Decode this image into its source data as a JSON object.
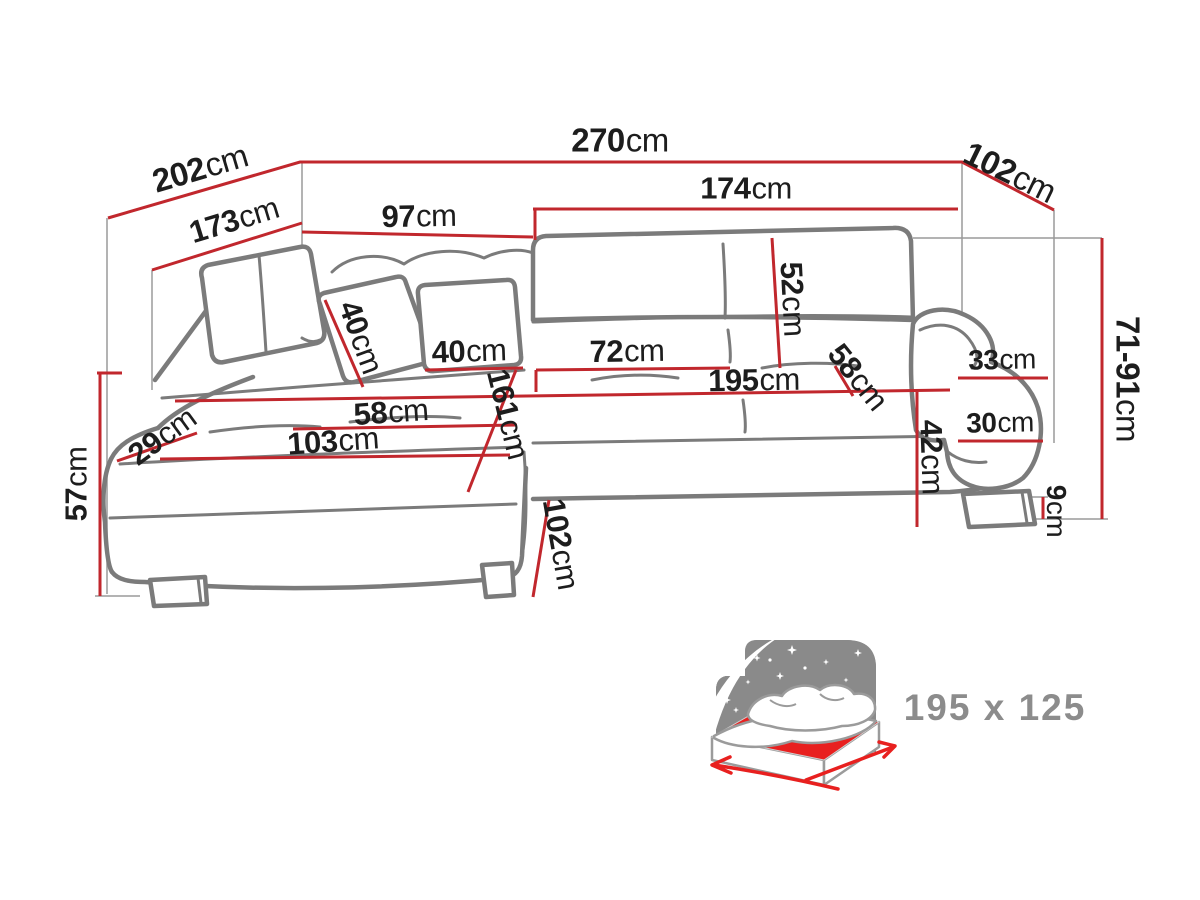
{
  "page": {
    "description": "Technical dimension diagram of a corner sofa bed with sleeping-surface icon"
  },
  "colors": {
    "red": "#c1272d",
    "outline": "#7b7b7b",
    "guide": "#9a9a9a",
    "text": "#1d1d1d",
    "icon_gray": "#8a8a8a",
    "mattress": "#e8201f",
    "bed_label": "#8c8c8c"
  },
  "dims": {
    "d202": {
      "num": "202",
      "unit": "cm"
    },
    "d270": {
      "num": "270",
      "unit": "cm"
    },
    "d102_top": {
      "num": "102",
      "unit": "cm"
    },
    "d173": {
      "num": "173",
      "unit": "cm"
    },
    "d97": {
      "num": "97",
      "unit": "cm"
    },
    "d174": {
      "num": "174",
      "unit": "cm"
    },
    "d52": {
      "num": "52",
      "unit": "cm"
    },
    "d40_left": {
      "num": "40",
      "unit": "cm"
    },
    "d40_right": {
      "num": "40",
      "unit": "cm"
    },
    "d72": {
      "num": "72",
      "unit": "cm"
    },
    "d195": {
      "num": "195",
      "unit": "cm"
    },
    "d58_right": {
      "num": "58",
      "unit": "cm"
    },
    "d58_left": {
      "num": "58",
      "unit": "cm"
    },
    "d103": {
      "num": "103",
      "unit": "cm"
    },
    "d29": {
      "num": "29",
      "unit": "cm"
    },
    "d161": {
      "num": "161",
      "unit": "cm"
    },
    "d42": {
      "num": "42",
      "unit": "cm"
    },
    "d33": {
      "num": "33",
      "unit": "cm"
    },
    "d30": {
      "num": "30",
      "unit": "cm"
    },
    "d71_91": {
      "num": "71-91",
      "unit": "cm"
    },
    "d9": {
      "num": "9",
      "unit": "cm"
    },
    "d102_bottom": {
      "num": "102",
      "unit": "cm"
    },
    "d57": {
      "num": "57",
      "unit": "cm"
    }
  },
  "bed_icon": {
    "name": "sleeping-area-bed-icon",
    "size_label": "195 x 125"
  }
}
